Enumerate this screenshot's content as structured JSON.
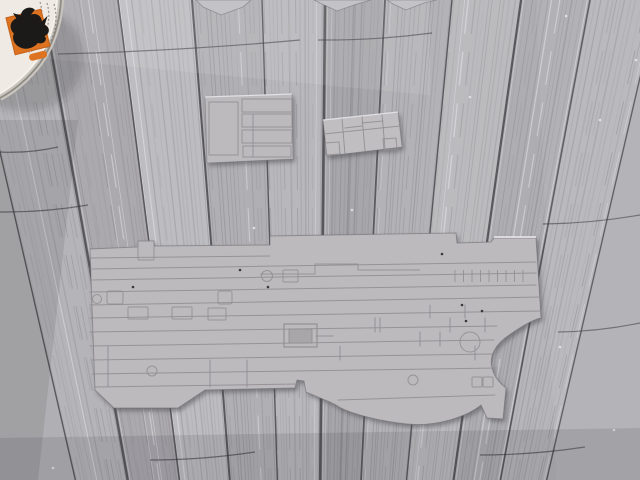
{
  "meta": {
    "type": "photograph",
    "description": "Grey injection-molded model-kit deck parts lying on a weathered grey wooden plank table; a round paint tin with an orange dragon-logo label sits in the top-left corner; three small sprue fragments poke into the frame along the top edge",
    "width": 640,
    "height": 480
  },
  "palette": {
    "wood_base": "#b0afb3",
    "wood_seam": "#4a494d",
    "plastic": "#bcbabd",
    "plastic_line": "#8f8d90",
    "pot_label": "#efeae3",
    "pot_orange": "#dd7320",
    "logo_black": "#1c1a18"
  },
  "wood": {
    "seam_tops": [
      -35,
      42,
      118,
      192,
      262,
      325,
      385,
      452,
      521,
      590,
      658
    ],
    "vp_x": 310,
    "bottom_factor": 0.32,
    "plank_shades": [
      "#b5b4b8",
      "#aba9ae",
      "#bdbcc0",
      "#b0afb3",
      "#b8b7bb",
      "#a7a6aa",
      "#b3b2b6",
      "#bbbabd",
      "#aeadb1",
      "#b6b5b9"
    ],
    "seam_widths": [
      1.4,
      2.4,
      1.6,
      2.0,
      1.4,
      2.6,
      1.8,
      1.4,
      2.2,
      1.6,
      1.4
    ],
    "streaks_per_plank": 14,
    "cracks": [
      [
        58,
        54,
        300,
        40
      ],
      [
        318,
        40,
        432,
        33
      ],
      [
        0,
        152,
        58,
        147
      ],
      [
        0,
        212,
        88,
        205
      ],
      [
        543,
        224,
        640,
        215
      ],
      [
        558,
        332,
        640,
        323
      ],
      [
        150,
        460,
        255,
        452
      ],
      [
        480,
        455,
        585,
        447
      ]
    ],
    "specks": [
      [
        566,
        16
      ],
      [
        470,
        97
      ],
      [
        521,
        243
      ],
      [
        560,
        347
      ],
      [
        614,
        430
      ],
      [
        53,
        468
      ],
      [
        352,
        210
      ],
      [
        600,
        120
      ],
      [
        636,
        60
      ],
      [
        254,
        228
      ]
    ]
  },
  "overlays": [
    {
      "points": [
        [
          40,
          0
        ],
        [
          430,
          0
        ],
        [
          430,
          95
        ],
        [
          40,
          58
        ]
      ],
      "fill": "rgba(255,255,255,0.09)"
    },
    {
      "points": [
        [
          536,
          0
        ],
        [
          640,
          0
        ],
        [
          640,
          480
        ],
        [
          556,
          480
        ]
      ],
      "fill": "rgba(255,255,255,0.06)"
    },
    {
      "points": [
        [
          0,
          120
        ],
        [
          78,
          120
        ],
        [
          38,
          480
        ],
        [
          0,
          480
        ]
      ],
      "fill": "rgba(28,28,33,0.10)"
    },
    {
      "points": [
        [
          0,
          438
        ],
        [
          640,
          428
        ],
        [
          640,
          480
        ],
        [
          0,
          480
        ]
      ],
      "fill": "rgba(24,24,29,0.10)"
    }
  ],
  "paint_pot": {
    "body_path": "M0,0 L61,0 C60,22 53,45 40,63 C27,80 13,91 0,98 Z",
    "rim_path": "M61,0 C60,22 53,45 40,63 C27,80 13,91 0,98",
    "inner_rim_path": "M57,0 C56,21 50,42 37,60 C25,76 12,86 0,93",
    "label_arcs": [
      "M54,4 A52,52 0 0 1 35,60",
      "M47,3 A45,45 0 0 1 29,53",
      "M40,2 A38,38 0 0 1 24,46"
    ],
    "square": {
      "x": 10,
      "y": 13,
      "w": 36,
      "h": 38,
      "rotate": -14,
      "cx": 28,
      "cy": 32
    },
    "pill": {
      "x": 23,
      "y": 54,
      "w": 18,
      "h": 7
    },
    "dragon_path": "M18,46 C12,42 10,35 14,30 C10,24 13,17 20,16 L18,10 L25,14 C28,7 37,7 40,12 L35,16 C41,15 45,20 44,25 L51,21 L46,29 C51,33 49,39 43,40 C46,45 39,48 35,45 C30,49 22,49 18,46 Z",
    "shadow": {
      "cx": 26,
      "cy": 58,
      "rx": 58,
      "ry": 54
    }
  },
  "fragments": [
    [
      [
        196,
        0
      ],
      [
        251,
        0
      ],
      [
        243,
        7
      ],
      [
        221,
        15
      ],
      [
        203,
        7
      ]
    ],
    [
      [
        314,
        0
      ],
      [
        371,
        0
      ],
      [
        357,
        4
      ],
      [
        337,
        11
      ],
      [
        322,
        4
      ]
    ],
    [
      [
        387,
        0
      ],
      [
        437,
        0
      ],
      [
        424,
        3
      ],
      [
        406,
        10
      ],
      [
        393,
        4
      ]
    ]
  ],
  "piece_small_left": {
    "outline": [
      [
        205,
        97
      ],
      [
        292,
        94
      ],
      [
        293,
        159
      ],
      [
        207,
        163
      ]
    ],
    "rects": [
      [
        209,
        102,
        29,
        53
      ],
      [
        242,
        99,
        50,
        13
      ],
      [
        242,
        114,
        50,
        13
      ],
      [
        242,
        130,
        50,
        13
      ],
      [
        243,
        146,
        48,
        11
      ]
    ],
    "lines": [
      [
        253,
        114,
        253,
        157
      ]
    ],
    "top_highlight": [
      205,
      97,
      292,
      94
    ]
  },
  "piece_small_right": {
    "outline": [
      [
        323,
        120
      ],
      [
        398,
        112
      ],
      [
        402,
        147
      ],
      [
        327,
        156
      ]
    ],
    "lines": [
      [
        324,
        134,
        400,
        126
      ],
      [
        342,
        119,
        345,
        154
      ],
      [
        362,
        116,
        365,
        151
      ],
      [
        382,
        114,
        385,
        149
      ],
      [
        362,
        123,
        383,
        121
      ],
      [
        345,
        128,
        362,
        126
      ]
    ],
    "squares": [
      [
        [
          325,
          143
        ],
        [
          339,
          142
        ],
        [
          340,
          154
        ],
        [
          326,
          155
        ]
      ],
      [
        [
          383,
          139
        ],
        [
          396,
          138
        ],
        [
          397,
          149
        ],
        [
          384,
          150
        ]
      ]
    ],
    "top_highlight": [
      323,
      120,
      398,
      112
    ]
  },
  "piece_large": {
    "outline": "M90,249 L138,247 L138,241 L154,241 L154,246 L270,245 L270,236 L456,233 L457,243 L491,242 L494,238 L536,238 L541,318 Q530,320 505,338 Q488,352 492,368 Q495,380 506,388 L503,419 L487,418 L481,405 C468,416 437,427 407,424 C377,421 345,412 336,405 L330,402 L306,392 L304,381 L297,380 L295,388 L250,389 L205,390 L178,408 L114,408 L95,390 Z",
    "panel_lines": [
      [
        90,
        258,
        270,
        256
      ],
      [
        90,
        269,
        536,
        262
      ],
      [
        90,
        280,
        536,
        273
      ],
      [
        90,
        292,
        536,
        285
      ],
      [
        90,
        305,
        541,
        297
      ],
      [
        90,
        318,
        541,
        311
      ],
      [
        90,
        332,
        497,
        326
      ],
      [
        90,
        346,
        494,
        340
      ],
      [
        92,
        360,
        492,
        354
      ],
      [
        92,
        374,
        497,
        368
      ],
      [
        95,
        387,
        298,
        384
      ],
      [
        338,
        400,
        495,
        395
      ]
    ],
    "extra_lines": [
      [
        108,
        346,
        108,
        386
      ],
      [
        247,
        360,
        247,
        387
      ],
      [
        340,
        346,
        340,
        360
      ],
      [
        375,
        318,
        375,
        332
      ],
      [
        420,
        332,
        420,
        346
      ],
      [
        430,
        305,
        430,
        318
      ],
      [
        465,
        305,
        465,
        318
      ],
      [
        450,
        318,
        450,
        332
      ],
      [
        485,
        318,
        485,
        332
      ],
      [
        440,
        332,
        440,
        346
      ],
      [
        475,
        346,
        475,
        360
      ],
      [
        316,
        336,
        333,
        336
      ],
      [
        380,
        318,
        380,
        332
      ],
      [
        210,
        360,
        210,
        387
      ]
    ],
    "step_polyline": [
      [
        260,
        274
      ],
      [
        315,
        274
      ],
      [
        315,
        264
      ],
      [
        358,
        264
      ],
      [
        358,
        270
      ],
      [
        420,
        270
      ]
    ],
    "detail_rects": [
      [
        107,
        291,
        16,
        13,
        2
      ],
      [
        218,
        291,
        14,
        13,
        2
      ],
      [
        128,
        307,
        20,
        12,
        1
      ],
      [
        172,
        307,
        20,
        12,
        1
      ],
      [
        208,
        308,
        18,
        12,
        1
      ],
      [
        283,
        270,
        15,
        12,
        1
      ],
      [
        138,
        241,
        16,
        19,
        1
      ],
      [
        472,
        377,
        10,
        10,
        1
      ],
      [
        483,
        377,
        10,
        10,
        1
      ]
    ],
    "circles": [
      [
        267,
        276,
        5.5
      ],
      [
        470,
        342,
        10
      ],
      [
        413,
        380,
        5
      ],
      [
        152,
        371,
        5
      ],
      [
        97,
        299,
        4.5
      ]
    ],
    "elevator": {
      "outer": [
        284,
        324,
        33,
        23
      ],
      "inner": [
        289,
        329,
        23,
        14
      ],
      "inner_fill": "#a8a6a9"
    },
    "ticks": {
      "x0": 455,
      "step": 8.5,
      "count": 9,
      "y1": 270,
      "y2": 282
    },
    "dots": [
      [
        133,
        287
      ],
      [
        442,
        254
      ],
      [
        462,
        305
      ],
      [
        482,
        311
      ],
      [
        466,
        321
      ],
      [
        268,
        287
      ],
      [
        240,
        270
      ]
    ],
    "highlight_line": [
      494,
      237,
      536,
      237
    ]
  }
}
